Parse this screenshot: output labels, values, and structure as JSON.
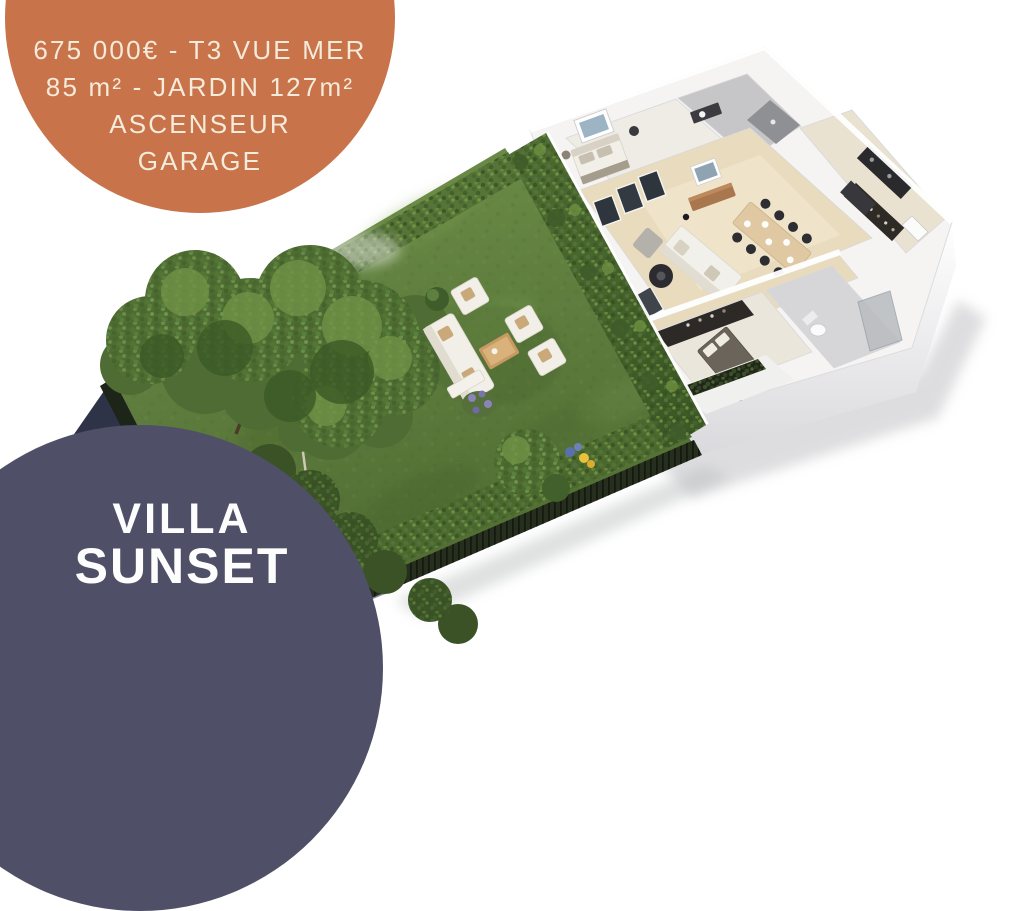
{
  "price_badge": {
    "line1": "675 000€ - T3 VUE MER",
    "line2": "85 m² - JARDIN 127m²",
    "line3": "ASCENSEUR",
    "line4": "GARAGE"
  },
  "name_badge": {
    "line1": "VILLA",
    "line2": "SUNSET"
  },
  "colors": {
    "orange": "#c8734a",
    "cream": "#f5ebda",
    "navy": "#4f4f68",
    "white": "#fdfdfd",
    "lawnA": "#6f8d47",
    "lawnB": "#53703441",
    "lawnBase": "#5c7a3b",
    "hedge": "#4d6a31",
    "vine": "#47632e",
    "tree": "#4e6c33",
    "fence": "#262e1e",
    "wall": "#f5f4f2",
    "floorBeige": "#e9dcbe",
    "shadowNavy": "#262b3f",
    "wood": "#c79a63",
    "dark": "#2d2d31"
  }
}
